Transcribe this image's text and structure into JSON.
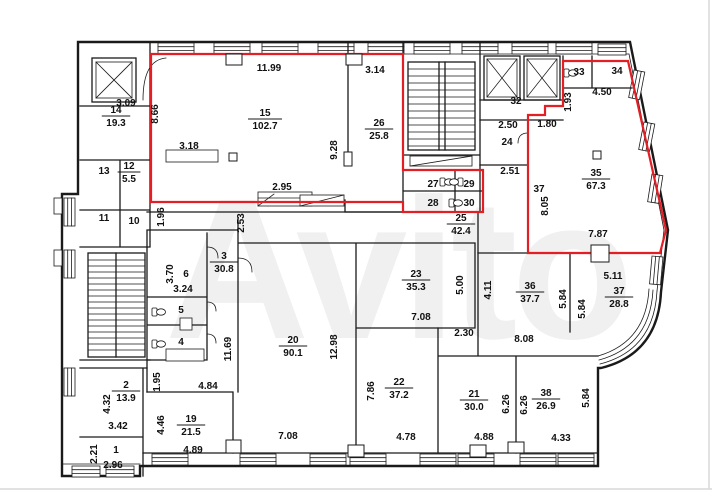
{
  "watermark": "Avito",
  "colors": {
    "highlight": "#e31e24",
    "line": "#1a1a1a",
    "background": "#ffffff",
    "watermark": "#f0f0f0"
  },
  "room_labels": [
    {
      "num": "15",
      "area": "102.7",
      "x": 265,
      "y": 116
    },
    {
      "num": "26",
      "area": "25.8",
      "x": 379,
      "y": 126
    },
    {
      "num": "14",
      "area": "19.3",
      "x": 116,
      "y": 113
    },
    {
      "num": "12",
      "area": "5.5",
      "x": 129,
      "y": 169
    },
    {
      "num": "35",
      "area": "67.3",
      "x": 596,
      "y": 176
    },
    {
      "num": "25",
      "area": "42.4",
      "x": 461,
      "y": 221
    },
    {
      "num": "3",
      "area": "30.8",
      "x": 224,
      "y": 259
    },
    {
      "num": "23",
      "area": "35.3",
      "x": 416,
      "y": 277
    },
    {
      "num": "36",
      "area": "37.7",
      "x": 530,
      "y": 289
    },
    {
      "num": "37",
      "area": "28.8",
      "x": 619,
      "y": 294
    },
    {
      "num": "20",
      "area": "90.1",
      "x": 293,
      "y": 343
    },
    {
      "num": "22",
      "area": "37.2",
      "x": 399,
      "y": 385
    },
    {
      "num": "21",
      "area": "30.0",
      "x": 474,
      "y": 397
    },
    {
      "num": "38",
      "area": "26.9",
      "x": 546,
      "y": 396
    },
    {
      "num": "19",
      "area": "21.5",
      "x": 191,
      "y": 422
    },
    {
      "num": "2",
      "area": "13.9",
      "x": 126,
      "y": 388
    },
    {
      "num": "13",
      "area": null,
      "x": 104,
      "y": 174
    },
    {
      "num": "11",
      "area": null,
      "x": 104,
      "y": 221
    },
    {
      "num": "10",
      "area": null,
      "x": 134,
      "y": 224
    },
    {
      "num": "6",
      "area": null,
      "x": 186,
      "y": 277
    },
    {
      "num": "5",
      "area": null,
      "x": 181,
      "y": 313
    },
    {
      "num": "4",
      "area": null,
      "x": 181,
      "y": 345
    },
    {
      "num": "1",
      "area": null,
      "x": 116,
      "y": 453
    },
    {
      "num": "32",
      "area": null,
      "x": 516,
      "y": 104
    },
    {
      "num": "33",
      "area": null,
      "x": 579,
      "y": 75
    },
    {
      "num": "34",
      "area": null,
      "x": 617,
      "y": 74
    },
    {
      "num": "24",
      "area": null,
      "x": 507,
      "y": 145
    },
    {
      "num": "27",
      "area": null,
      "x": 433,
      "y": 187
    },
    {
      "num": "29",
      "area": null,
      "x": 469,
      "y": 187
    },
    {
      "num": "28",
      "area": null,
      "x": 433,
      "y": 206
    },
    {
      "num": "30",
      "area": null,
      "x": 469,
      "y": 206
    },
    {
      "num": "37",
      "area": null,
      "x": 539,
      "y": 192
    }
  ],
  "dim_labels": [
    {
      "text": "11.99",
      "x": 269,
      "y": 71,
      "rot": 0
    },
    {
      "text": "3.14",
      "x": 375,
      "y": 73,
      "rot": 0
    },
    {
      "text": "3.09",
      "x": 126,
      "y": 106,
      "rot": 0
    },
    {
      "text": "8.66",
      "x": 158,
      "y": 114,
      "rot": -90
    },
    {
      "text": "3.18",
      "x": 189,
      "y": 149,
      "rot": 0
    },
    {
      "text": "2.95",
      "x": 282,
      "y": 190,
      "rot": 0
    },
    {
      "text": "9.28",
      "x": 337,
      "y": 150,
      "rot": -90
    },
    {
      "text": "1.96",
      "x": 164,
      "y": 217,
      "rot": -90
    },
    {
      "text": "2.53",
      "x": 244,
      "y": 223,
      "rot": -90
    },
    {
      "text": "1.93",
      "x": 571,
      "y": 102,
      "rot": -90
    },
    {
      "text": "4.50",
      "x": 602,
      "y": 95,
      "rot": 0
    },
    {
      "text": "1.80",
      "x": 547,
      "y": 127,
      "rot": 0
    },
    {
      "text": "2.50",
      "x": 508,
      "y": 128,
      "rot": 0
    },
    {
      "text": "2.51",
      "x": 510,
      "y": 174,
      "rot": 0
    },
    {
      "text": "8.05",
      "x": 548,
      "y": 206,
      "rot": -90
    },
    {
      "text": "7.87",
      "x": 598,
      "y": 237,
      "rot": 0
    },
    {
      "text": "5.11",
      "x": 613,
      "y": 279,
      "rot": 0
    },
    {
      "text": "5.84",
      "x": 566,
      "y": 299,
      "rot": -90
    },
    {
      "text": "5.84",
      "x": 585,
      "y": 309,
      "rot": -90
    },
    {
      "text": "4.11",
      "x": 491,
      "y": 290,
      "rot": -90
    },
    {
      "text": "5.00",
      "x": 463,
      "y": 285,
      "rot": -90
    },
    {
      "text": "7.08",
      "x": 421,
      "y": 320,
      "rot": 0
    },
    {
      "text": "2.30",
      "x": 464,
      "y": 336,
      "rot": 0
    },
    {
      "text": "8.08",
      "x": 524,
      "y": 342,
      "rot": 0
    },
    {
      "text": "12.98",
      "x": 337,
      "y": 347,
      "rot": -90
    },
    {
      "text": "11.69",
      "x": 231,
      "y": 349,
      "rot": -90
    },
    {
      "text": "3.70",
      "x": 173,
      "y": 274,
      "rot": -90
    },
    {
      "text": "3.24",
      "x": 183,
      "y": 292,
      "rot": 0
    },
    {
      "text": "1.95",
      "x": 160,
      "y": 382,
      "rot": -90
    },
    {
      "text": "4.84",
      "x": 208,
      "y": 389,
      "rot": 0
    },
    {
      "text": "4.46",
      "x": 164,
      "y": 425,
      "rot": -90
    },
    {
      "text": "4.89",
      "x": 193,
      "y": 453,
      "rot": 0
    },
    {
      "text": "4.32",
      "x": 110,
      "y": 404,
      "rot": -90
    },
    {
      "text": "3.42",
      "x": 118,
      "y": 429,
      "rot": 0
    },
    {
      "text": "2.21",
      "x": 97,
      "y": 454,
      "rot": -90
    },
    {
      "text": "2.96",
      "x": 113,
      "y": 468,
      "rot": 0
    },
    {
      "text": "7.08",
      "x": 288,
      "y": 439,
      "rot": 0
    },
    {
      "text": "7.86",
      "x": 374,
      "y": 391,
      "rot": -90
    },
    {
      "text": "4.78",
      "x": 406,
      "y": 440,
      "rot": 0
    },
    {
      "text": "6.26",
      "x": 509,
      "y": 404,
      "rot": -90
    },
    {
      "text": "6.26",
      "x": 527,
      "y": 405,
      "rot": -90
    },
    {
      "text": "5.84",
      "x": 589,
      "y": 398,
      "rot": -90
    },
    {
      "text": "4.33",
      "x": 561,
      "y": 441,
      "rot": 0
    },
    {
      "text": "4.88",
      "x": 484,
      "y": 440,
      "rot": 0
    }
  ]
}
